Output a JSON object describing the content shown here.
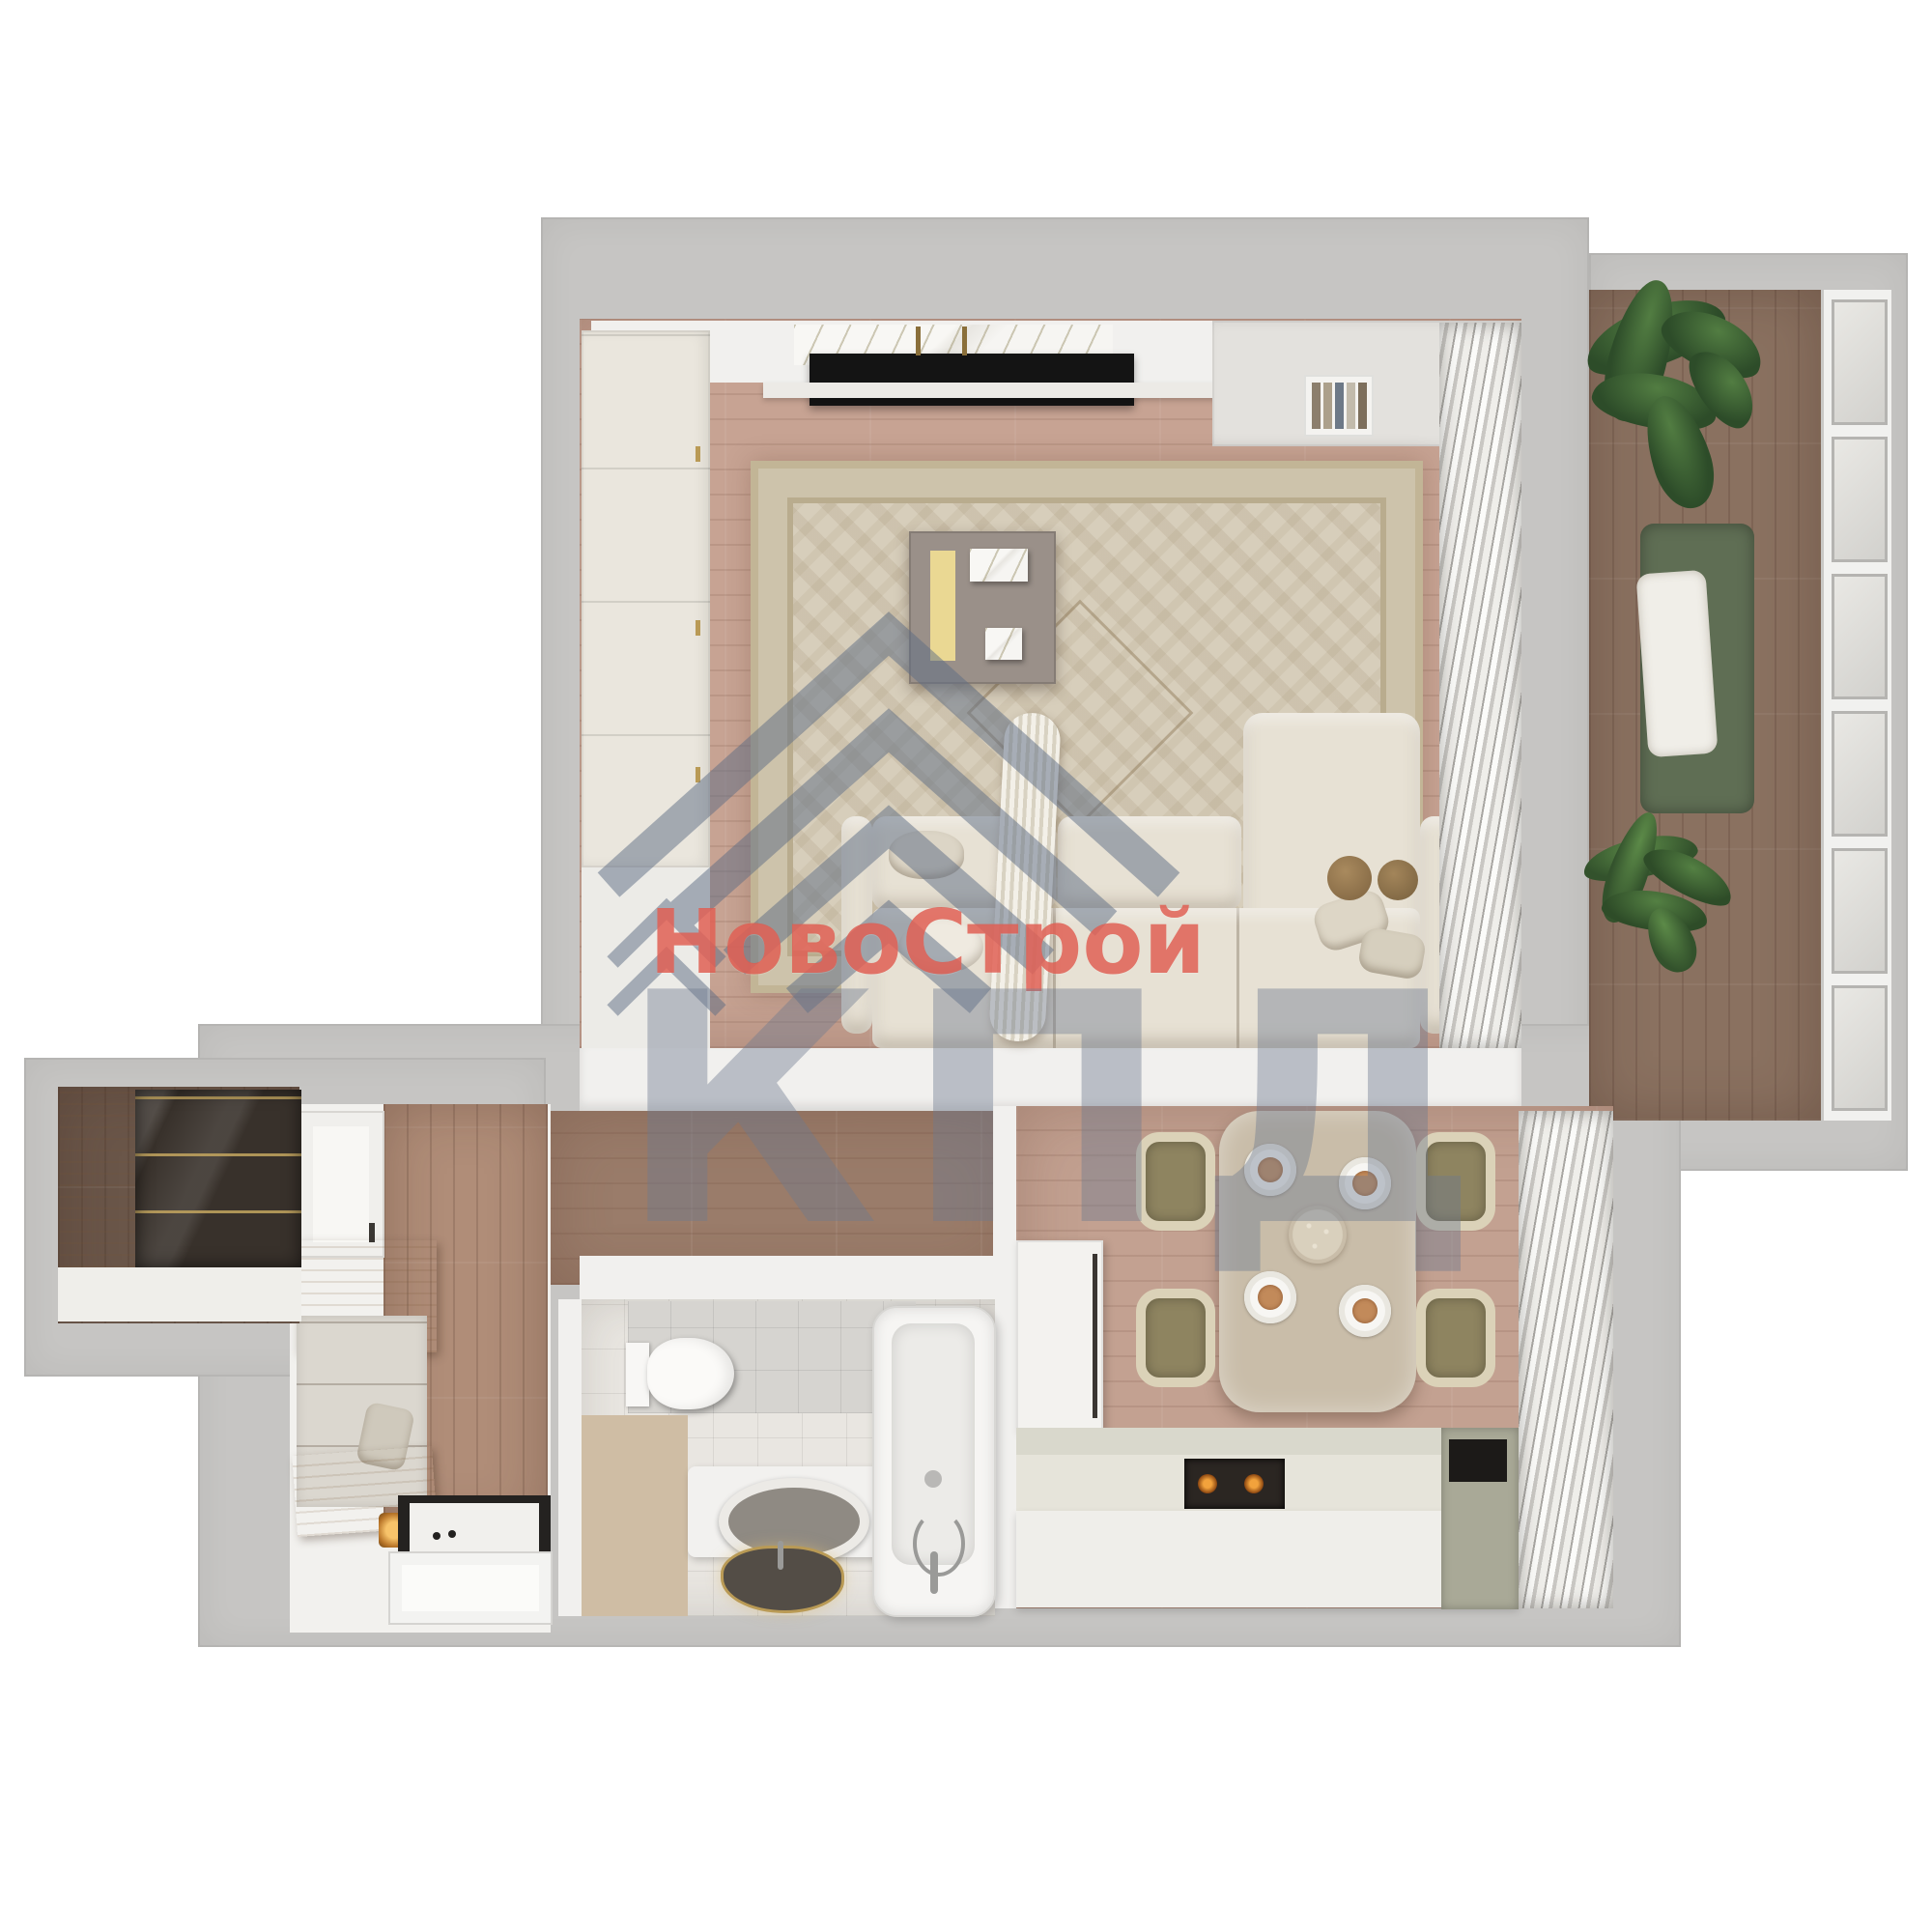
{
  "watermark": {
    "logo_icon": "roof-chevron-icon",
    "title": "НовоСтрой",
    "subtitle": "КПД",
    "title_color": "#df5a4e",
    "subtitle_color": "#6e7a90",
    "logo_color": "#5e6d85"
  },
  "scene": {
    "type": "apartment floor plan, top-down 3D render",
    "rooms": [
      "living room",
      "balcony",
      "kitchen-dining room",
      "bathroom",
      "hallway",
      "entry closet"
    ],
    "furniture": [
      "wardrobe",
      "tv-console",
      "tv",
      "area-rug",
      "coffee-table",
      "sofa",
      "curtains",
      "plant",
      "daybed",
      "window-wall",
      "dining-table",
      "dining-chairs",
      "plates",
      "fridge-column",
      "kitchen-counter",
      "stove",
      "cooktop",
      "toilet",
      "vanity-mirror",
      "sink",
      "bathtub",
      "travertine-bench",
      "glass-wardrobe",
      "hall-bench",
      "shoe-bench",
      "doormat",
      "entry-door"
    ]
  },
  "details": {
    "balcony_window_panes": 6,
    "dining_seats": 4,
    "sofa_seat_cushions": 3,
    "stove_burners_lit": 2
  },
  "palette": {
    "page_bg": "#ffffff",
    "wall": "#c6c5c3",
    "wall_face": "#f1f0ee",
    "floor_living": "#c7a393",
    "floor_corridor": "#9a7c6a",
    "floor_balcony": "#8a7160",
    "floor_kitchen": "#c3a191",
    "tile_floor": "#e9e6e1",
    "tile_wall": "#d6d4d0",
    "rug_field": "#d7cebb",
    "sofa_fabric": "#e7e1d4",
    "cabinet_cream": "#eae6dd",
    "counter_sage": "#a9a997",
    "wood_light": "#d2ba97",
    "glass_dark": "#38312b",
    "accent_yellow": "#ead893",
    "plant_green": "#3c5c34",
    "burner_glow": "#f2a23c",
    "tv_black": "#141414"
  }
}
